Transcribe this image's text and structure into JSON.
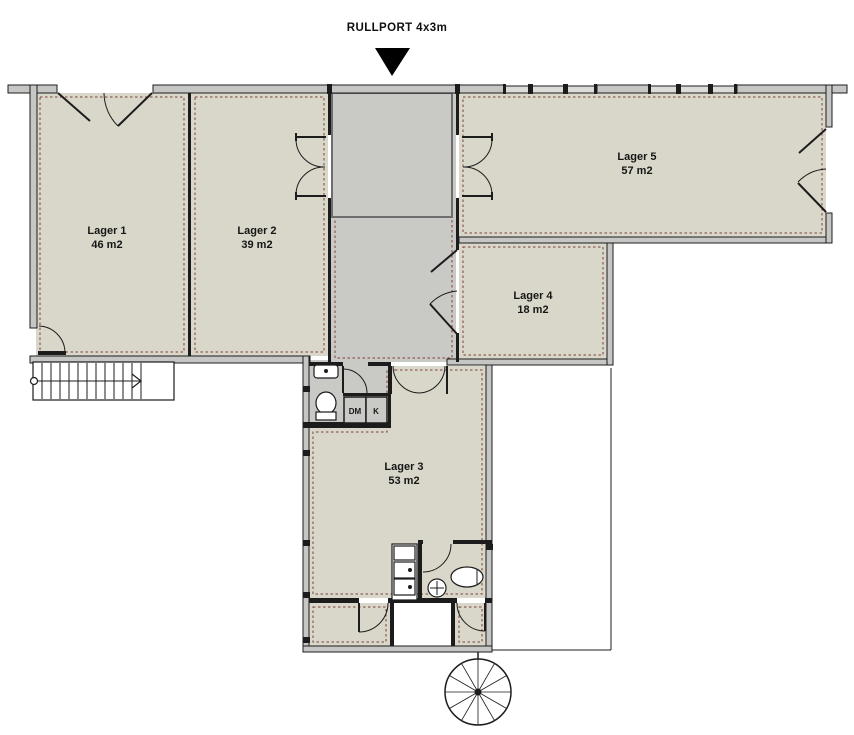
{
  "plan": {
    "rullport_label": "RULLPORT 4x3m",
    "rullport_marker": "down-arrow",
    "rooms": [
      {
        "id": "lager-1",
        "name": "Lager 1",
        "area": "46 m2"
      },
      {
        "id": "lager-2",
        "name": "Lager 2",
        "area": "39 m2"
      },
      {
        "id": "lager-3",
        "name": "Lager 3",
        "area": "53 m2"
      },
      {
        "id": "lager-4",
        "name": "Lager 4",
        "area": "18 m2"
      },
      {
        "id": "lager-5",
        "name": "Lager 5",
        "area": "57 m2"
      }
    ],
    "closets": {
      "dm_label": "DM",
      "k_label": "K"
    },
    "colors": {
      "background": "#ffffff",
      "room_fill": "#d9d7ca",
      "hall_fill": "#c9c9c6",
      "wall_fill": "#c6c6c4",
      "line": "#1c1c1c",
      "insulation_dash": "#7d4038",
      "rullport_outline": "#6e6e6e",
      "arrow": "#000000"
    }
  }
}
